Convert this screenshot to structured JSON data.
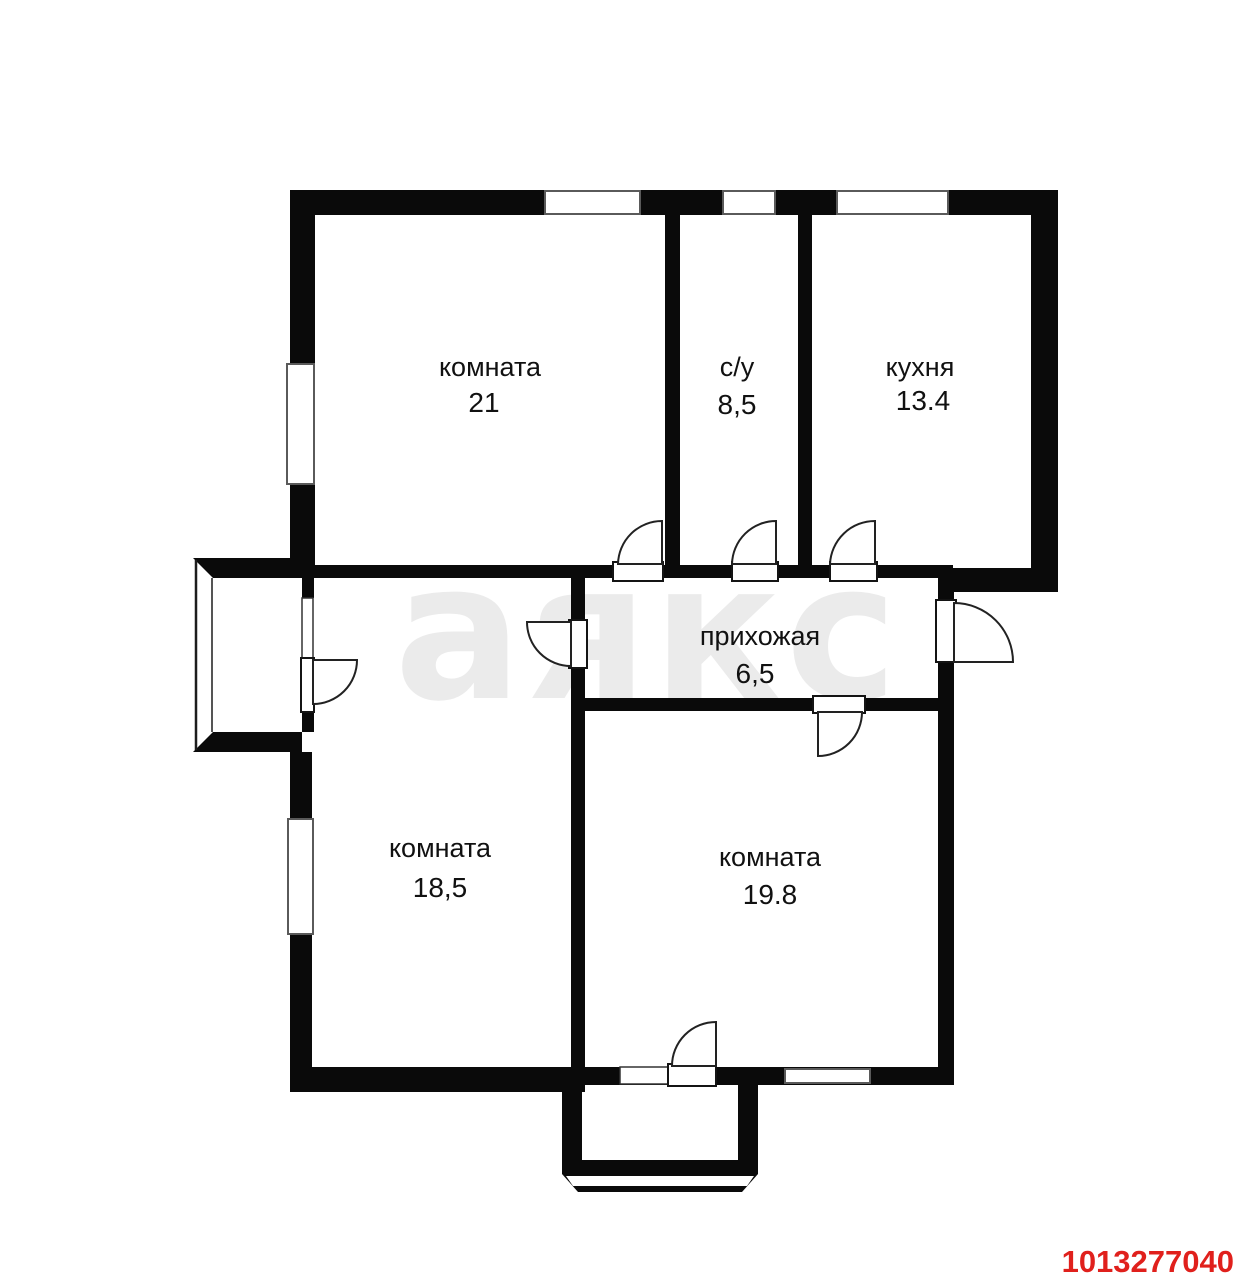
{
  "plan": {
    "watermark": {
      "text": "аякс",
      "color": "#ebebeb"
    },
    "listing_id": {
      "text": "1013277040",
      "color": "#e0201c"
    },
    "wall_color": "#0a0a0a",
    "rooms": [
      {
        "key": "room-top-left",
        "label": "комната",
        "area": "21"
      },
      {
        "key": "bathroom",
        "label": "с/у",
        "area": "8,5"
      },
      {
        "key": "kitchen",
        "label": "кухня",
        "area": "13.4"
      },
      {
        "key": "hallway",
        "label": "прихожая",
        "area": "6,5"
      },
      {
        "key": "room-bottom-left",
        "label": "комната",
        "area": "18,5"
      },
      {
        "key": "room-bottom-right",
        "label": "комната",
        "area": "19.8"
      }
    ]
  }
}
